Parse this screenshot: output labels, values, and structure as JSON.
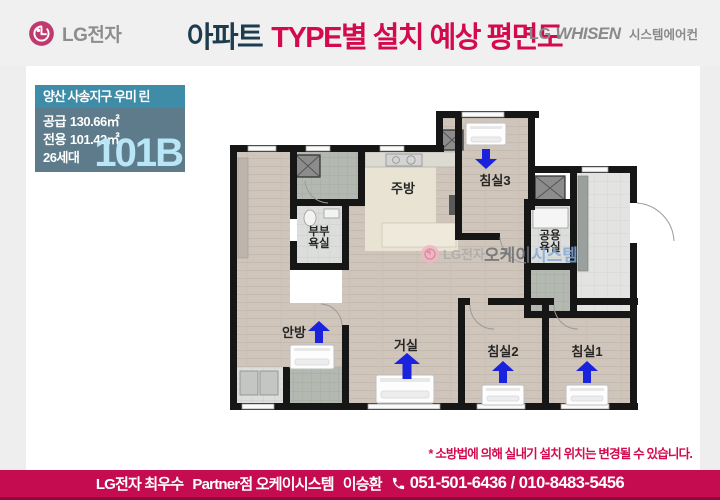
{
  "header": {
    "logo": {
      "brand": "LG전자"
    },
    "title": {
      "part1": "아파트",
      "part2": "TYPE별 설치 예상 평면도"
    },
    "right_logo": {
      "lg": "LG",
      "whisen": "WHISEN",
      "suffix": "시스템에어컨"
    }
  },
  "info_box": {
    "title": "양산 사송지구 우미 린",
    "rows": [
      {
        "label": "공급",
        "value": "130.66㎡"
      },
      {
        "label": "전용",
        "value": "101.42㎡"
      },
      {
        "label": "26세대",
        "value": ""
      }
    ],
    "type_code": "101B"
  },
  "floor_plan": {
    "rooms": {
      "kitchen": "주방",
      "bedroom3": "침실3",
      "master_bath": {
        "line1": "부부",
        "line2": "욕실"
      },
      "common_bath": {
        "line1": "공용",
        "line2": "욕실"
      },
      "master_bedroom": "안방",
      "living": "거실",
      "bedroom2": "침실2",
      "bedroom1": "침실1"
    },
    "watermark": {
      "brand": "LG전자",
      "word1": "오케이",
      "word2": "시스템"
    }
  },
  "disclaimer": "* 소방법에 의해 실내기 설치 위치는 변경될 수 있습니다.",
  "footer": {
    "line1": "LG전자 최우수",
    "line2": "Partner점 오케이시스템",
    "name": "이승환",
    "phone": "051-501-6436 / 010-8483-5456"
  },
  "colors": {
    "accent": "#d40a4e",
    "navy": "#1d3d4f",
    "teal": "#3e8ca8",
    "slate": "#5d7b8a",
    "type_code": "#b9e6f6",
    "arrow_blue": "#1b22dd",
    "footer_bg": "#c60c50"
  }
}
